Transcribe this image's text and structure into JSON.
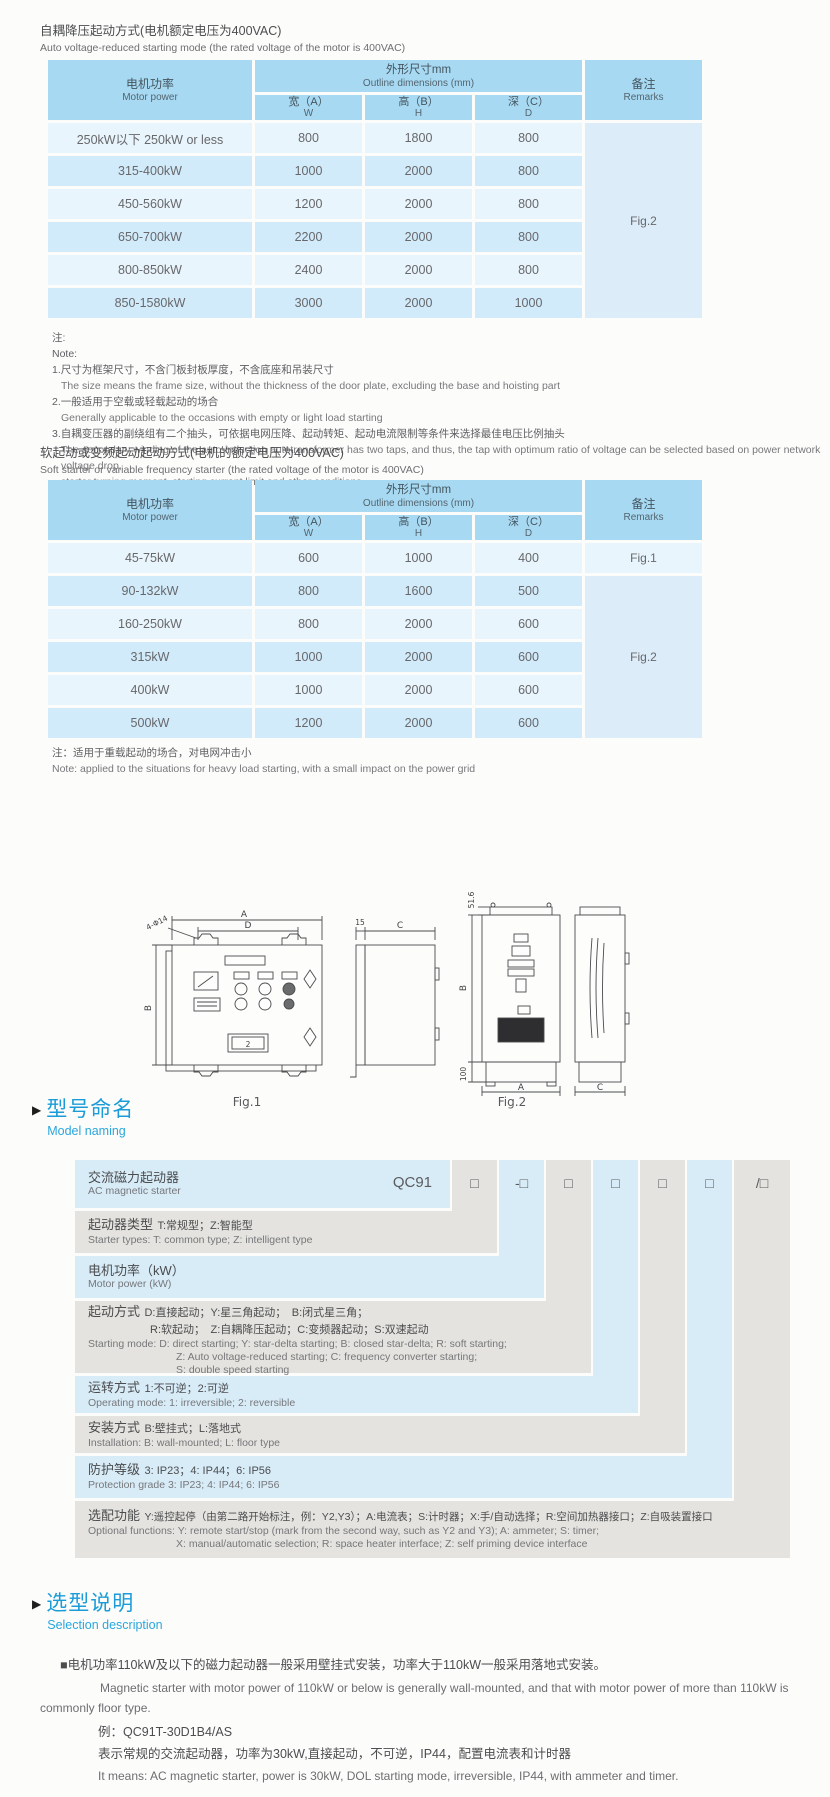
{
  "section1": {
    "title_zh": "自耦降压起动方式(电机额定电压为400VAC)",
    "title_en": "Auto voltage-reduced starting mode (the rated voltage of the motor is 400VAC)"
  },
  "table_header": {
    "motor_zh": "电机功率",
    "motor_en": "Motor power",
    "dims_zh": "外形尺寸mm",
    "dims_en": "Outline dimensions (mm)",
    "w_zh": "宽（A）",
    "w_en": "W",
    "h_zh": "高（B）",
    "h_en": "H",
    "d_zh": "深（C）",
    "d_en": "D",
    "remarks_zh": "备注",
    "remarks_en": "Remarks"
  },
  "table1": {
    "rows": [
      {
        "power": "250kW以下 250kW or less",
        "w": "800",
        "h": "1800",
        "d": "800"
      },
      {
        "power": "315-400kW",
        "w": "1000",
        "h": "2000",
        "d": "800"
      },
      {
        "power": "450-560kW",
        "w": "1200",
        "h": "2000",
        "d": "800"
      },
      {
        "power": "650-700kW",
        "w": "2200",
        "h": "2000",
        "d": "800"
      },
      {
        "power": "800-850kW",
        "w": "2400",
        "h": "2000",
        "d": "800"
      },
      {
        "power": "850-1580kW",
        "w": "3000",
        "h": "2000",
        "d": "1000"
      }
    ],
    "remark_merged": "Fig.2"
  },
  "notes1": {
    "zh_mark": "注:",
    "en_mark": "Note:",
    "item1_zh": "1.尺寸为框架尺寸，不含门板封板厚度，不含底座和吊装尺寸",
    "item1_en": "The size means the frame size, without the thickness of the door plate, excluding the base and hoisting part",
    "item2_zh": "2.一般适用于空载或轻载起动的场合",
    "item2_en": "Generally applicable to the occasions with empty or light load starting",
    "item3_zh": "3.自耦变压器的副绕组有二个抽头，可依据电网压降、起动转矩、起动电流限制等条件来选择最佳电压比例抽头",
    "item3_en": "The secondary winding of the auto-induction autotransformer has two taps, and thus, the tap with optimum ratio of voltage can be selected based on power network voltage drop,",
    "item3_en2": "starter turning moment, starting current limit and other conditions"
  },
  "section2": {
    "title_zh": "软起动或变频起动起动方式(电机的额定电压为400VAC)",
    "title_en": "Soft starter or variable frequency starter (the rated voltage of the motor is 400VAC)"
  },
  "table2": {
    "rows": [
      {
        "power": "45-75kW",
        "w": "600",
        "h": "1000",
        "d": "400"
      },
      {
        "power": "90-132kW",
        "w": "800",
        "h": "1600",
        "d": "500"
      },
      {
        "power": "160-250kW",
        "w": "800",
        "h": "2000",
        "d": "600"
      },
      {
        "power": "315kW",
        "w": "1000",
        "h": "2000",
        "d": "600"
      },
      {
        "power": "400kW",
        "w": "1000",
        "h": "2000",
        "d": "600"
      },
      {
        "power": "500kW",
        "w": "1200",
        "h": "2000",
        "d": "600"
      }
    ],
    "remark_row1": "Fig.1",
    "remark_merged": "Fig.2"
  },
  "note2": {
    "zh": "注：适用于重载起动的场合，对电网冲击小",
    "en": "Note: applied to the situations for heavy load starting, with a small impact on the power grid"
  },
  "figures": {
    "fig1": {
      "caption": "Fig.1",
      "labels": {
        "width": "A",
        "holes_span": "D",
        "height": "B",
        "holes": "4-Φ14",
        "side_offset": "15",
        "depth": "C",
        "panel_tag": "2"
      }
    },
    "fig2": {
      "caption": "Fig.2",
      "labels": {
        "bar": "51.6",
        "height": "B",
        "base": "100",
        "width": "A",
        "depth": "C"
      }
    }
  },
  "model_naming": {
    "marker": "▶",
    "title_zh": "型号命名",
    "title_en": "Model naming",
    "prefix": "QC91",
    "boxes": [
      "□",
      "-□",
      "□",
      "□",
      "□",
      "□",
      "/□"
    ],
    "rows": [
      {
        "label": "交流磁力起动器",
        "en": "AC magnetic starter"
      },
      {
        "label": "起动器类型",
        "desc": "T:常规型；Z:智能型",
        "en": "Starter types: T: common type; Z: intelligent type"
      },
      {
        "label": "电机功率（kW）",
        "en": "Motor power (kW)"
      },
      {
        "label": "起动方式",
        "desc": "D:直接起动；Y:星三角起动；　B:闭式星三角；",
        "desc2": "R:软起动；　Z:自耦降压起动；C:变频器起动；S:双速起动",
        "en": "Starting mode: D: direct starting; Y: star-delta starting; B: closed star-delta; R: soft starting;",
        "en2": "Z: Auto voltage-reduced starting; C: frequency converter starting;",
        "en3": "S: double speed starting"
      },
      {
        "label": "运转方式",
        "desc": "1:不可逆；2:可逆",
        "en": "Operating mode: 1: irreversible; 2: reversible"
      },
      {
        "label": "安装方式",
        "desc": "B:壁挂式；L:落地式",
        "en": "Installation: B: wall-mounted;  L: floor type"
      },
      {
        "label": "防护等级",
        "desc": "3: IP23；4: IP44；6: IP56",
        "en": "Protection grade  3: IP23;  4: IP44;  6: IP56"
      },
      {
        "label": "选配功能",
        "desc": "Y:遥控起停（由第二路开始标注，例：Y2,Y3）；A:电流表；S:计时器；X:手/自动选择；R:空间加热器接口；Z:自吸装置接口",
        "en": "Optional functions: Y: remote start/stop (mark from the second way, such as Y2 and Y3); A: ammeter; S: timer;",
        "en2": "X: manual/automatic selection; R: space heater interface; Z: self priming device interface"
      }
    ]
  },
  "selection": {
    "marker": "▶",
    "title_zh": "选型说明",
    "title_en": "Selection description",
    "bullet": "■",
    "p1_zh": "电机功率110kW及以下的磁力起动器一般采用壁挂式安装，功率大于110kW一般采用落地式安装。",
    "p1_en": "Magnetic starter with motor power of 110kW or below is generally wall-mounted, and that with motor power of more than 110kW is commonly floor type.",
    "example_code": "例：QC91T-30D1B4/AS",
    "example_zh": "表示常规的交流起动器，功率为30kW,直接起动，不可逆，IP44，配置电流表和计时器",
    "example_en": "It means: AC magnetic starter, power is 30kW, DOL starting mode, irreversible, IP44, with ammeter and timer."
  }
}
